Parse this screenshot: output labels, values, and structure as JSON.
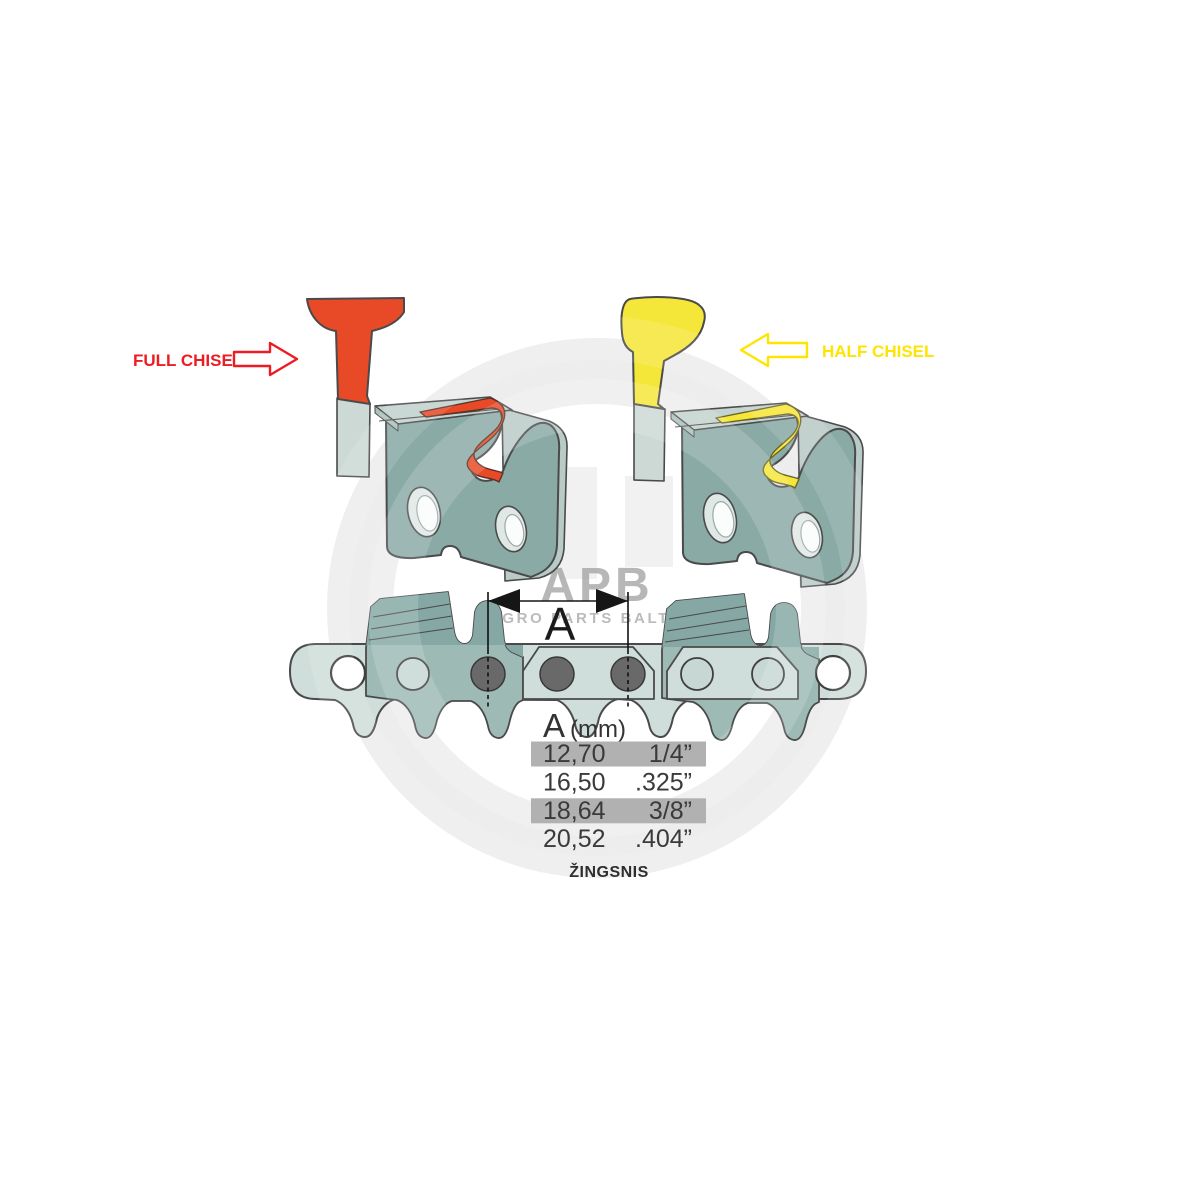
{
  "diagram": {
    "labels": {
      "full_chisel": "FULL CHISEL",
      "half_chisel": "HALF CHISEL",
      "dimension_letter": "A",
      "pitch_caption": "ŽINGSNIS"
    },
    "pitch_table": {
      "header": {
        "letter": "A",
        "unit": "(mm)"
      },
      "rows": [
        {
          "mm": "12,70",
          "inch": "1/4”",
          "highlighted": true
        },
        {
          "mm": "16,50",
          "inch": ".325”",
          "highlighted": false
        },
        {
          "mm": "18,64",
          "inch": "3/8”",
          "highlighted": true
        },
        {
          "mm": "20,52",
          "inch": ".404”",
          "highlighted": false
        }
      ]
    },
    "watermark": {
      "logo": "APB",
      "subtitle": "AGRO PARTS BALTIJA"
    },
    "colors": {
      "full_chisel_red": "#e84a27",
      "full_chisel_label_red": "#ed1c24",
      "half_chisel_yellow": "#f5e63a",
      "half_chisel_label_yellow": "#ffe400",
      "steel_body_teal": "#8aaaa6",
      "chain_strap_light": "#cfdeda",
      "cutter_plate_teal": "#9dbab5",
      "rivet_gray": "#696969",
      "highlight_bar_gray": "#b1b1b1",
      "outline_gray": "#4a4a4a"
    }
  }
}
